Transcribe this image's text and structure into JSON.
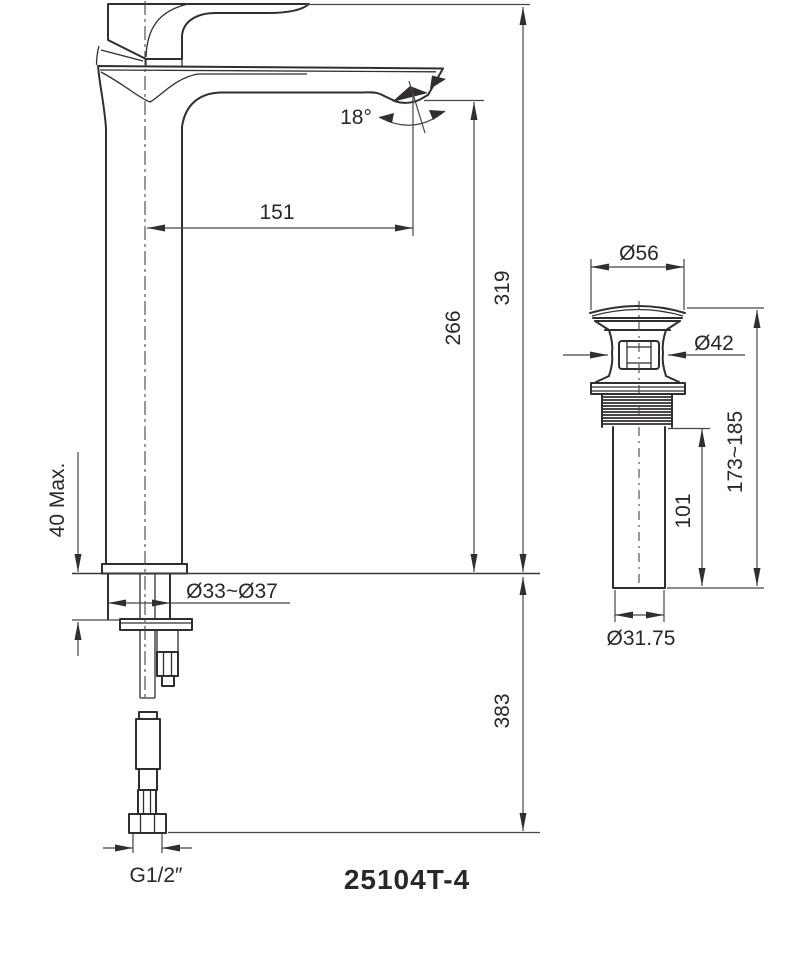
{
  "model": "25104T-4",
  "faucet": {
    "angle_label": "18°",
    "reach": "151",
    "spout_height": "266",
    "total_height": "319",
    "deck_max": "40 Max.",
    "hole_range": "Ø33~Ø37",
    "below_counter": "383",
    "thread": "G1/2″"
  },
  "drain": {
    "cap_diameter": "Ø56",
    "body_diameter": "Ø42",
    "length_range": "173~185",
    "tail_length": "101",
    "pipe_diameter": "Ø31.75"
  },
  "colors": {
    "line": "#332e2e",
    "background": "#ffffff"
  }
}
